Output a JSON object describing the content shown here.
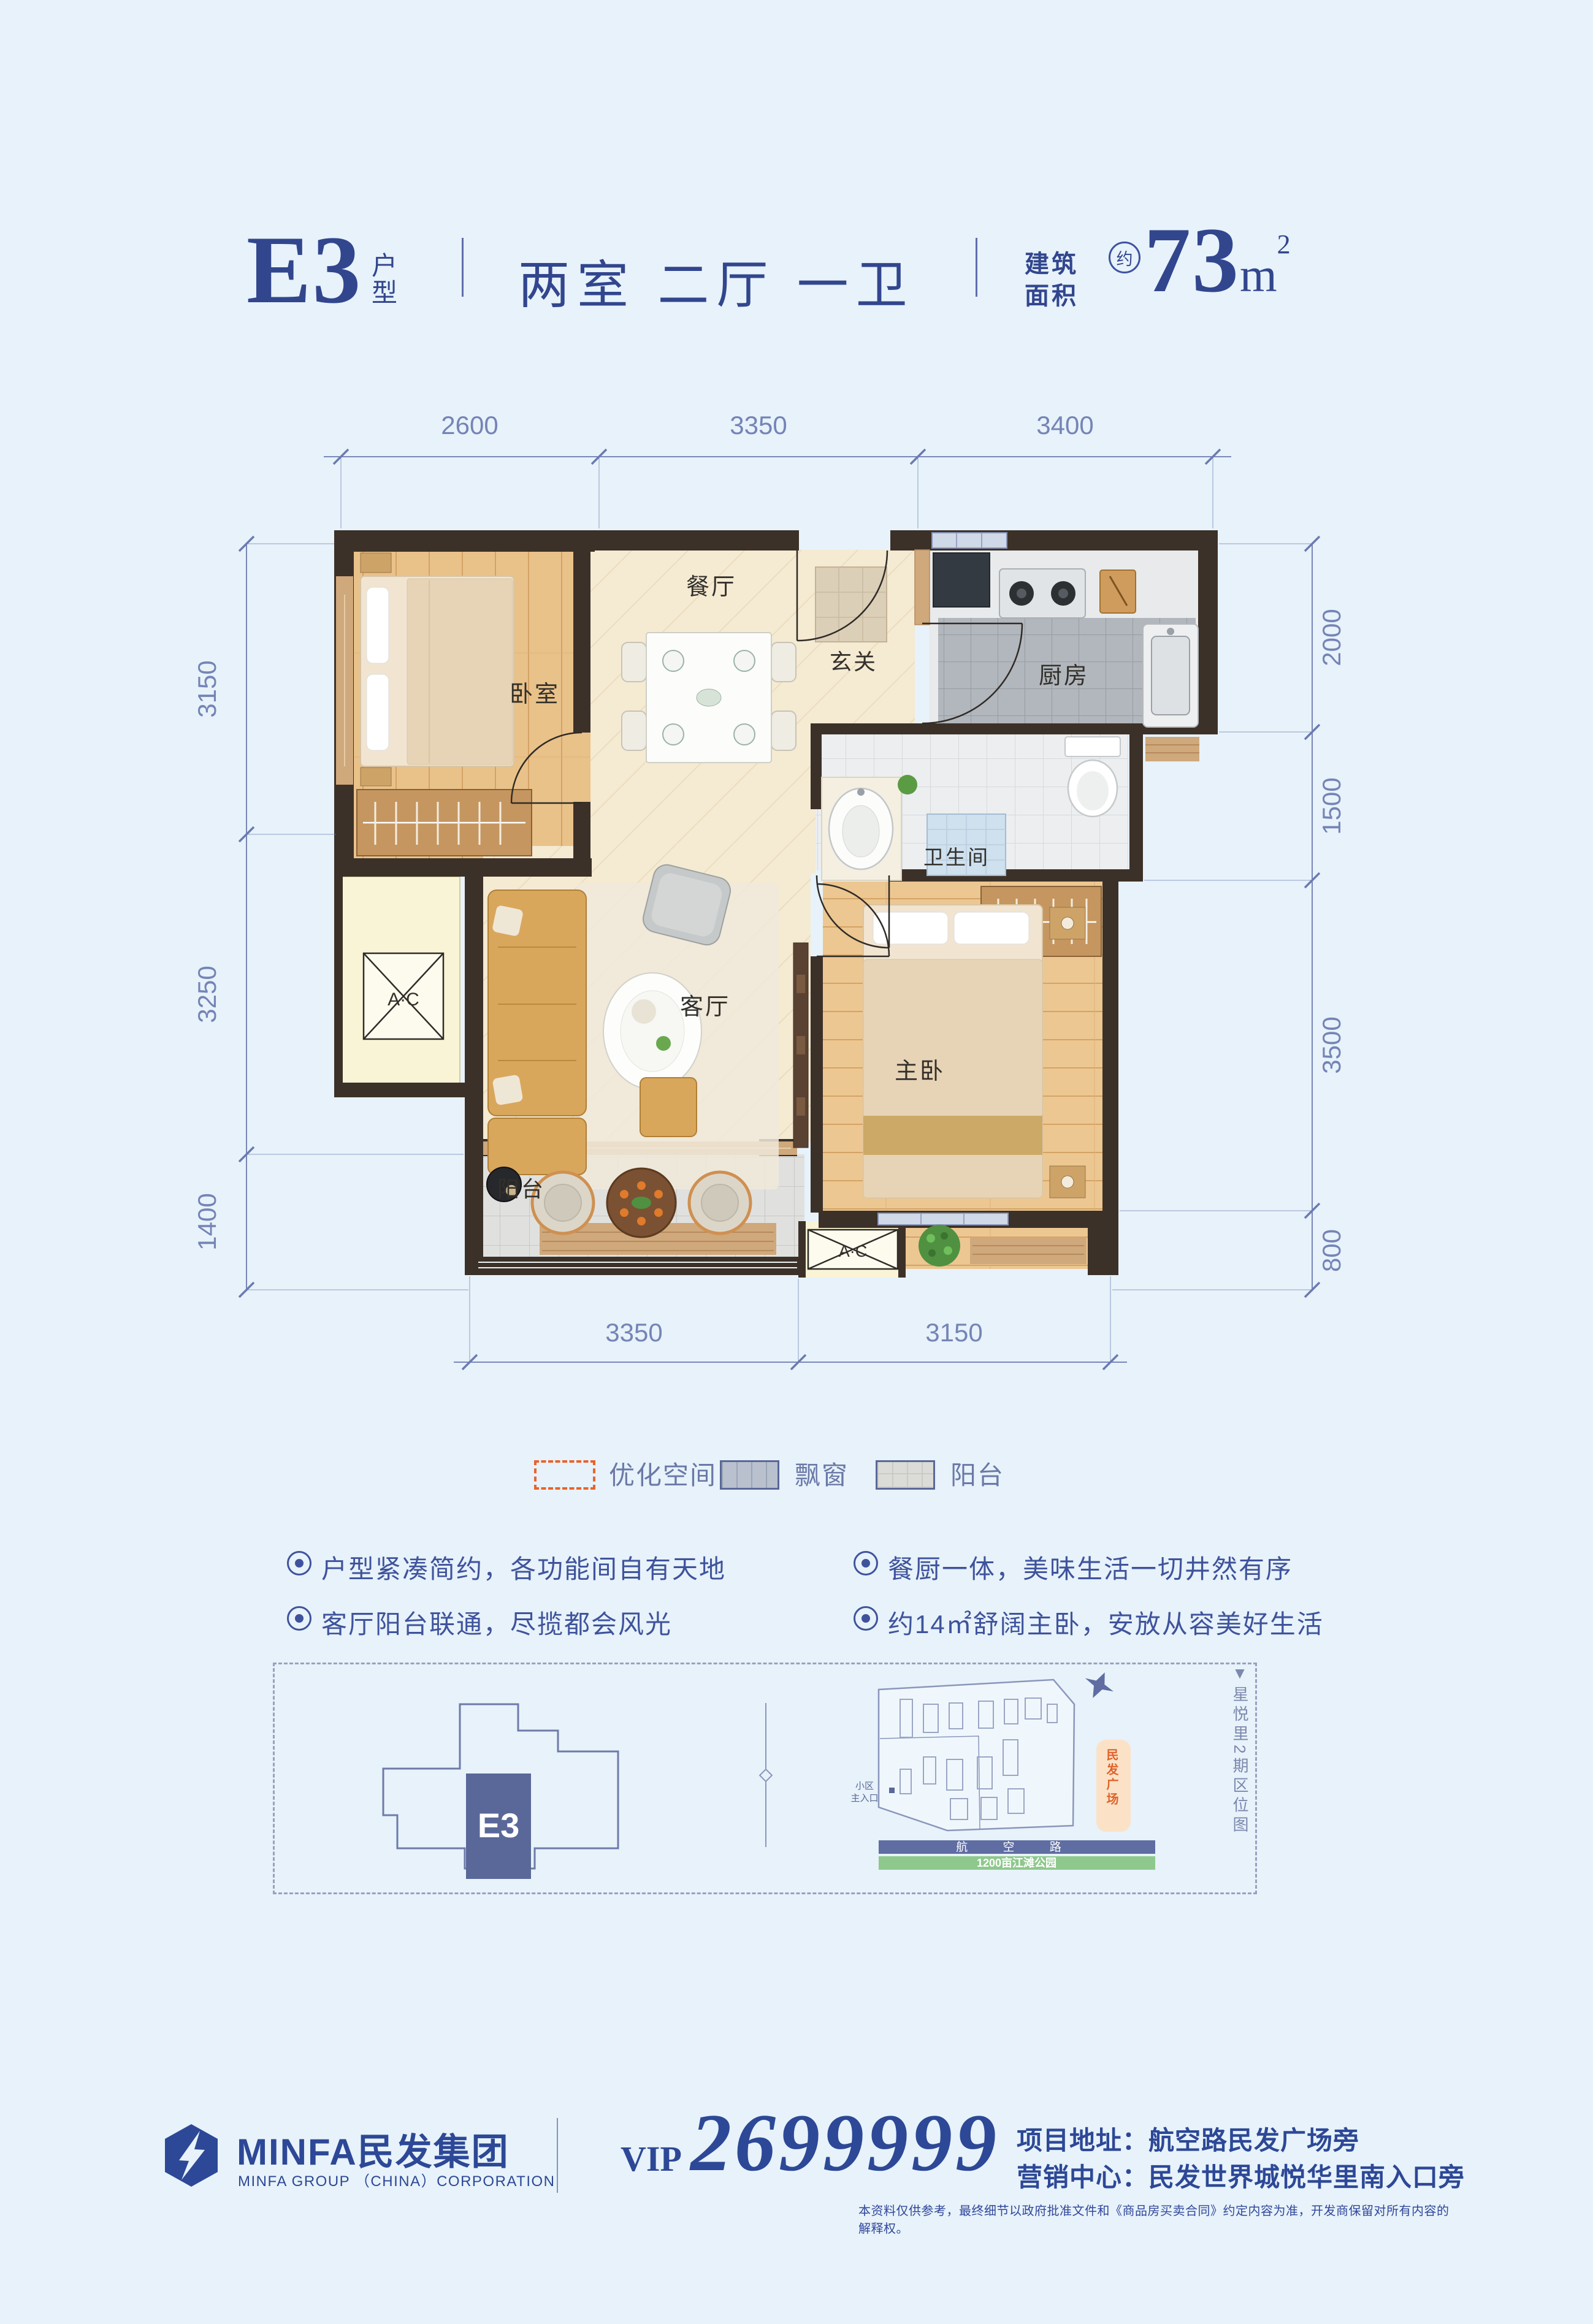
{
  "header": {
    "unit_code": "E3",
    "unit_type_label": "户型",
    "layout_text": "两室 二厅 一卫",
    "area_label_line1": "建筑",
    "area_label_line2": "面积",
    "approx_mark": "约",
    "area_number": "73",
    "area_unit": "m",
    "area_exponent": "2"
  },
  "floor_plan": {
    "dims_top": [
      "2600",
      "3350",
      "3400"
    ],
    "dims_bottom": [
      "3350",
      "3150"
    ],
    "dims_left": [
      "3150",
      "3250",
      "1400"
    ],
    "dims_right": [
      "2000",
      "1500",
      "3500",
      "800"
    ],
    "rooms": {
      "bedroom": "卧室",
      "dining": "餐厅",
      "entry": "玄关",
      "kitchen": "厨房",
      "bathroom": "卫生间",
      "living": "客厅",
      "master_bedroom": "主卧",
      "balcony": "阳台",
      "ac_left": "A·C",
      "ac_bottom": "A·C"
    }
  },
  "legend": {
    "items": [
      {
        "label": "优化空间"
      },
      {
        "label": "飘窗"
      },
      {
        "label": "阳台"
      }
    ]
  },
  "features": [
    {
      "text": "户型紧凑简约，各功能间自有天地"
    },
    {
      "text": "客厅阳台联通，尽揽都会风光"
    },
    {
      "text": "餐厨一体，美味生活一切井然有序"
    },
    {
      "text": "约14㎡舒阔主卧，安放从容美好生活"
    }
  ],
  "location": {
    "building_unit_label": "E3",
    "section_caption": "▼星悦里2期区位图",
    "entrance_line1": "小区",
    "entrance_line2": "主入口",
    "plaza_label": "民发广场",
    "road_label": "航 空 路",
    "park_label": "1200亩江滩公园"
  },
  "footer": {
    "brand_name": "MINFA民发集团",
    "brand_subtitle": "MINFA GROUP （CHINA）CORPORATION",
    "vip_label": "VIP",
    "vip_number": "2699999",
    "address_line": "项目地址：航空路民发广场旁",
    "sales_line": "营销中心：民发世界城悦华里南入口旁",
    "disclaimer": "本资料仅供参考，最终细节以政府批准文件和《商品房买卖合同》约定内容为准，开发商保留对所有内容的解释权。"
  },
  "colors": {
    "background": "#e7f2fa",
    "primary_navy": "#2d4896",
    "dim_blue": "#7584b6",
    "accent_orange": "#e8632c",
    "wall_dark": "#3c3128",
    "wall_tan": "#cfa87b"
  }
}
